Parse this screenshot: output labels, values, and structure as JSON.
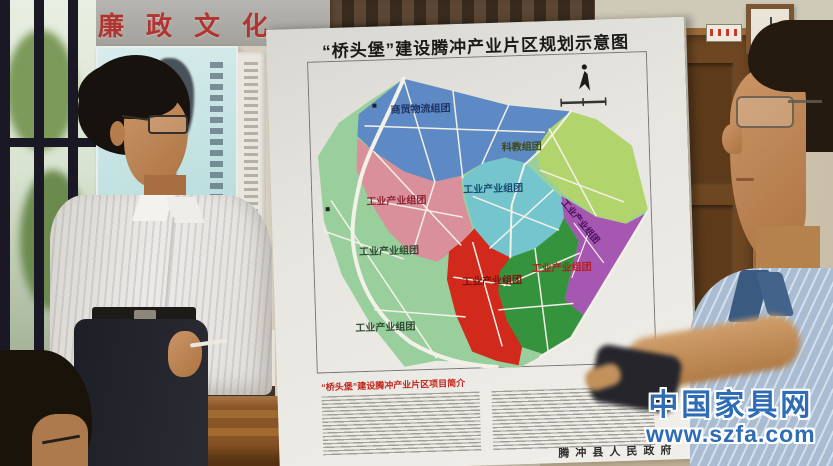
{
  "banner": {
    "text": "廉政文化"
  },
  "poster": {
    "title": "“桥头堡”建设腾冲产业片区规划示意图",
    "intro_title": "“桥头堡”建设腾冲产业片区项目简介",
    "signature": "腾冲县人民政府"
  },
  "map": {
    "road_color": "#f3f0e8",
    "regions": [
      {
        "name": "商贸物流组团",
        "color": "#5d89c4",
        "label_color": "#1e3264"
      },
      {
        "name": "科教组团",
        "color": "#b2d46d",
        "label_color": "#3c4a18"
      },
      {
        "name": "工业产业组团",
        "color": "#d9909b",
        "label_color": "#8e2533"
      },
      {
        "name": "工业产业组团",
        "color": "#74c5cd",
        "label_color": "#174a6e"
      },
      {
        "name": "工业产业组团",
        "color": "#a557b2",
        "label_color": "#45105c"
      },
      {
        "name": "工业产业组团",
        "color": "#d1291b",
        "label_color": "#7a100b"
      },
      {
        "name": "工业产业组团",
        "color": "#35923d",
        "label_color": "#b51d1d"
      },
      {
        "name": "工业产业组团",
        "color": "#99cf9d",
        "label_color": "#2e4a30"
      },
      {
        "name": "工业产业组团",
        "color": "#99cf9d",
        "label_color": "#2e4a30"
      }
    ]
  },
  "watermark": {
    "title": "中国家具网",
    "url": "www.szfa.com",
    "color": "#2e6cb5"
  }
}
